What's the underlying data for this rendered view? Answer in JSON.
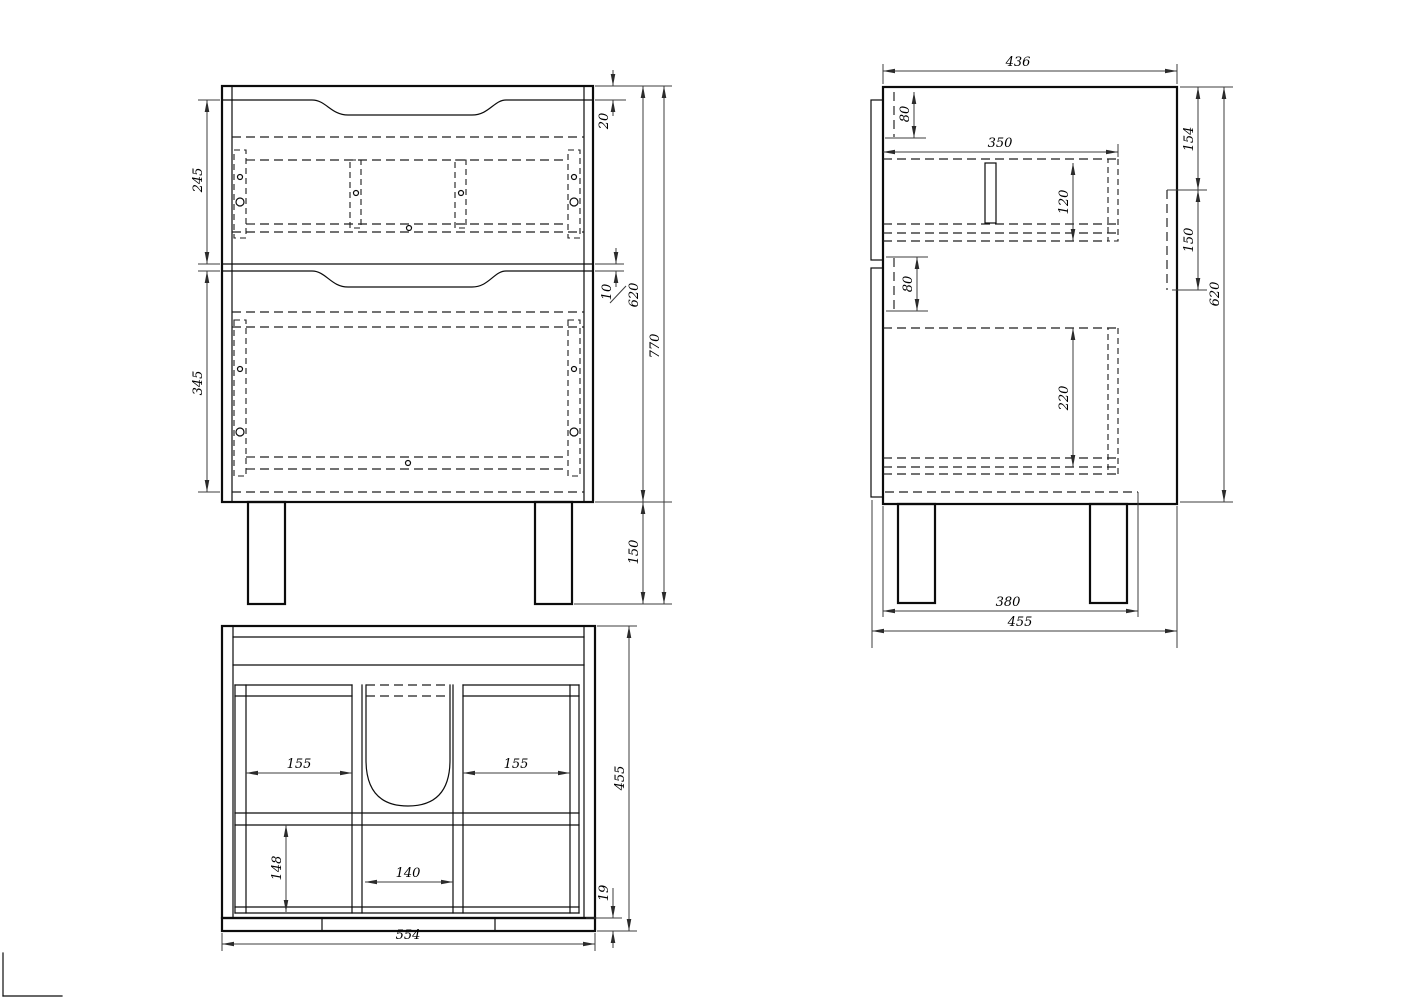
{
  "drawing": {
    "kind": "cabinet technical drawing",
    "views": {
      "front_view": {
        "dims": {
          "top_rail": "20",
          "drawer1_front_height": "245",
          "drawer_gap": "10",
          "drawer2_front_height": "345",
          "carcass_height": "620",
          "overall_height": "770",
          "leg_height": "150"
        }
      },
      "side_view": {
        "dims": {
          "carcass_depth": "436",
          "top_hole_offset": "80",
          "drawer_depth": "350",
          "side_top_offset": "154",
          "side_bracket_height": "150",
          "drawer1_box_height": "120",
          "lower_hole_offset": "80",
          "drawer2_box_height": "220",
          "carcass_height": "620",
          "leg_spacing": "380",
          "overall_depth": "455"
        }
      },
      "top_view": {
        "dims": {
          "left_bay_width": "155",
          "right_bay_width": "155",
          "center_bay_width": "140",
          "rear_bay_depth": "148",
          "overall_depth": "455",
          "back_panel_thickness": "19",
          "overall_width": "554"
        }
      }
    }
  }
}
